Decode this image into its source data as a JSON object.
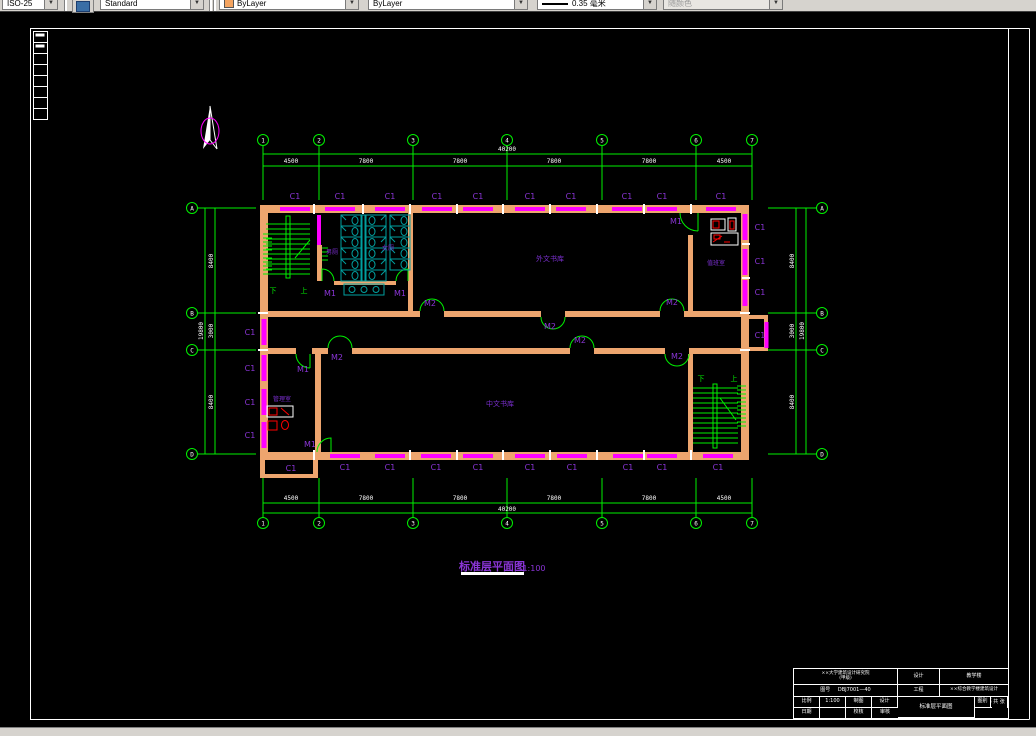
{
  "toolbar": {
    "dim_style": "ISO-25",
    "text_style": "Standard",
    "color": "ByLayer",
    "linetype": "ByLayer",
    "lineweight": "0.35 毫米",
    "plot_style": "随颜色"
  },
  "labels": {
    "window": "C1",
    "door_single": "M1",
    "door_double": "M2"
  },
  "rooms": {
    "stack_top": "外文书库",
    "stack_bottom": "中文书库",
    "wc_men": "男厕",
    "wc_women": "女厕",
    "office_top_right": "值班室",
    "office_bottom_left": "管理室",
    "stair_up": "上",
    "stair_down": "下"
  },
  "drawing": {
    "title": "标准层平面图",
    "scale": "1:100"
  },
  "grid": {
    "cols": [
      "1",
      "2",
      "3",
      "4",
      "5",
      "6",
      "7"
    ],
    "rows": [
      "A",
      "B",
      "C",
      "D"
    ],
    "top_dims": [
      "4500",
      "7800",
      "7800",
      "7800",
      "7800",
      "4500"
    ],
    "top_total": "40200",
    "bottom_dims": [
      "4500",
      "7800",
      "7800",
      "7800",
      "7800",
      "4500"
    ],
    "bottom_total": "40200",
    "left_dims": [
      "8400",
      "3000",
      "8400"
    ],
    "left_total": "19800",
    "right_dims": [
      "8400",
      "3000",
      "8400"
    ],
    "right_total": "19800"
  },
  "titleblock": {
    "org1": "××大学建筑设计研究院",
    "org2": "(甲级)",
    "r1_label": "设计",
    "r1_value": "教学楼",
    "r2_no_label": "图号",
    "r2_no_value": "DBJ7001—40",
    "r2_label": "工程",
    "r2_value": "××综合教学楼建筑设计",
    "drawing_name": "标准层平面图",
    "s_scale_label": "比例",
    "s_scale_value": "1:100",
    "s_draft": "制图",
    "s_design": "设计",
    "s_date": "日期",
    "s_check": "校核",
    "s_audit": "审核",
    "s_cat_label": "图别",
    "s_cat_value": "建施",
    "s_total": "共 张",
    "s_no": "第 张"
  }
}
